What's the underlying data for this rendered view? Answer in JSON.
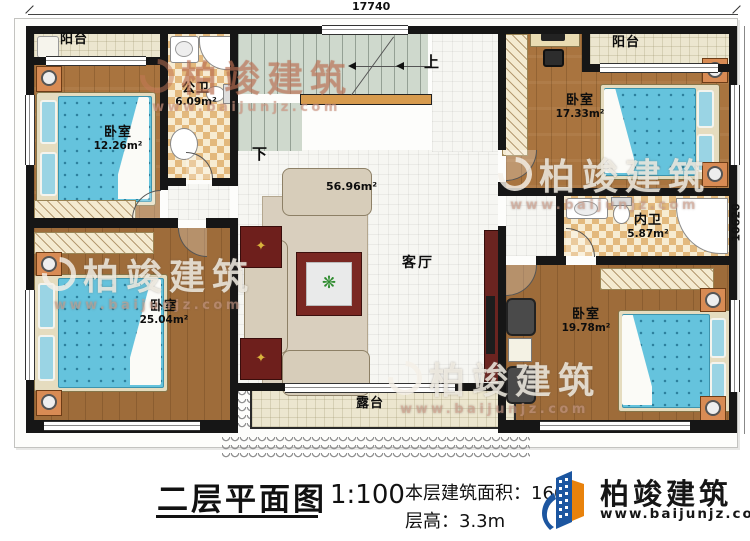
{
  "dimensions": {
    "top": "17740",
    "right": "10620"
  },
  "stairs": {
    "up_label": "上",
    "down_label": "下"
  },
  "rooms": [
    {
      "label": "阳台"
    },
    {
      "label": "公卫",
      "area": "6.09m²"
    },
    {
      "label": "卧室",
      "area": "12.26m²"
    },
    {
      "label": "卧室",
      "area": "17.33m²"
    },
    {
      "label": "阳台"
    },
    {
      "label": "内卫",
      "area": "5.87m²"
    },
    {
      "label": "客厅",
      "area": "56.96m²"
    },
    {
      "label": "卧室",
      "area": "25.04m²"
    },
    {
      "label": "卧室",
      "area": "19.78m²"
    },
    {
      "label": "露台"
    }
  ],
  "title_block": {
    "title": "二层平面图",
    "scale": "1:100",
    "floor_area": "本层建筑面积：166.6",
    "floor_height": "层高：3.3m"
  },
  "brand": {
    "name": "柏竣建筑",
    "url": "www.baijunjz.com"
  },
  "watermark": {
    "name": "柏竣建筑",
    "url": "www.baijunjz.com"
  },
  "colors": {
    "wall": "#161616",
    "wood_floor": "#a9743f",
    "mattress_blue": "#65c3dd",
    "brand_blue": "#1c56a0",
    "brand_orange": "#e8820c"
  }
}
